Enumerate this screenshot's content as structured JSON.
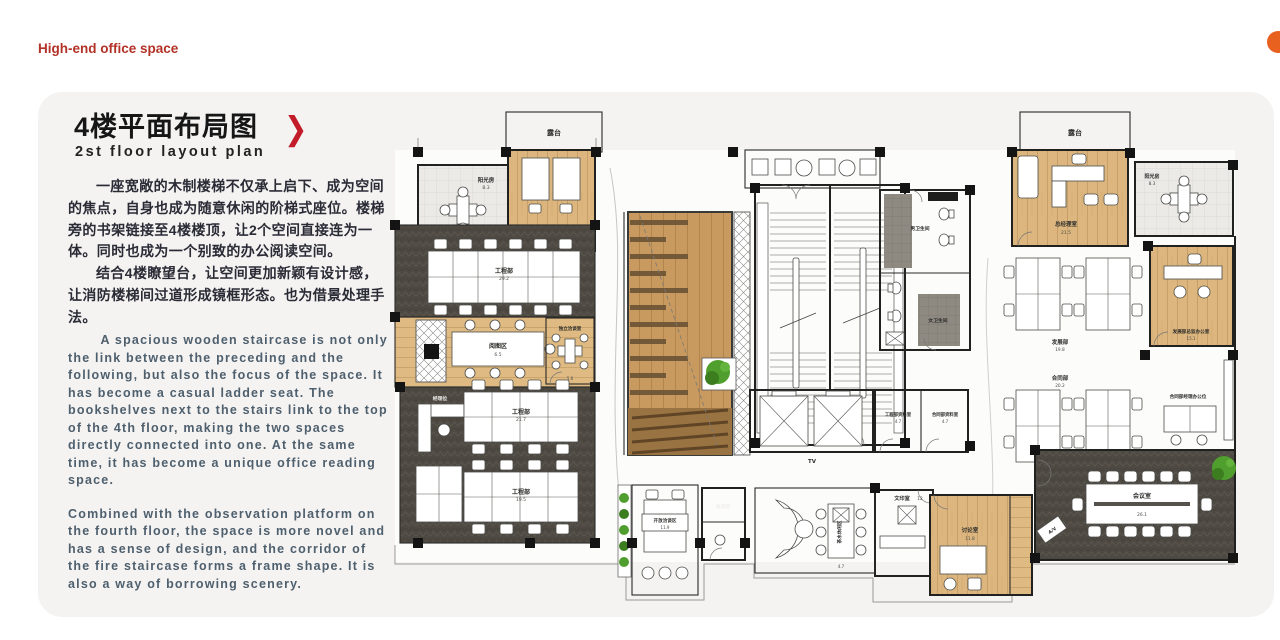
{
  "page": {
    "brand": "High-end office space"
  },
  "card": {
    "title": "4楼平面布局图",
    "subtitle": "2st floor layout plan",
    "arrow": "❯",
    "zh_paragraphs": [
      "一座宽敞的木制楼梯不仅承上启下、成为空间的焦点，自身也成为随意休闲的阶梯式座位。楼梯旁的书架链接至4楼楼顶，让2个空间直接连为一体。同时也成为一个别致的办公阅读空间。",
      "结合4楼瞭望台，让空间更加新颖有设计感，让消防楼梯间过道形成镜框形态。也为借景处理手法。"
    ],
    "en_paragraphs": [
      "A spacious wooden staircase is not only the link between the preceding and the following, but also the focus of the space. It has become a casual ladder seat. The bookshelves next to the stairs link to the top of the 4th floor, making the two spaces directly connected into one. At the same time, it has become a unique office reading space.",
      "Combined with the observation platform on the fourth floor, the space is more novel and has a sense of design, and the corridor of the fire staircase forms a frame shape. It is also a way of borrowing scenery."
    ]
  },
  "plan": {
    "labels": {
      "terrace_left": "露台",
      "terrace_right": "露台",
      "sunroom_left": "阳光房",
      "sunroom_right": "阳光房",
      "office_eng_director": "工程总监办公室",
      "eng_dept_1": "工程部",
      "eng_dept_2": "工程部",
      "eng_dept_3": "工程部",
      "manager_seat": "经理位",
      "reading_area": "阅图区",
      "indep_meeting": "独立洽谈室",
      "open_lounge": "开放洽谈区",
      "phone_room": "电话间",
      "tea_area": "茶水休闲区",
      "print_room": "文印室",
      "archive_eng": "工程部资料室",
      "archive_contract": "合同部资料室",
      "wc_men": "男卫生间",
      "wc_women": "女卫生间",
      "gm_office": "总经理室",
      "dev_dept": "发展部",
      "contract_dept": "合同部",
      "dev_director": "发展部总监办公室",
      "contract_mgr": "合同部经理办公位",
      "meeting_room": "会议室",
      "discussion_room": "讨论室",
      "tv": "TV",
      "av": "A/V"
    },
    "areas": {
      "sunroom_left": "8.3",
      "sunroom_right": "8.3",
      "office_eng_director": "26",
      "eng_dept_1": "29.2",
      "eng_dept_2": "21.7",
      "eng_dept_3": "19.5",
      "reading_area": "6.5",
      "indep_meeting": "5.6",
      "open_lounge": "11.9",
      "tea_area": "4.7",
      "print_room": "12",
      "archive_eng": "4.7",
      "archive_contract": "4.7",
      "gm_office": "21.5",
      "dev_dept": "19.8",
      "contract_dept": "20.2",
      "dev_director": "15.1",
      "meeting_room": "26.1",
      "discussion_room": "11.8"
    }
  },
  "colors": {
    "accent_red": "#c21b2a",
    "brand_red": "#b23227",
    "card_bg": "#f4f3f2",
    "carpet": "#4e4a43",
    "wood": "#dcb67e",
    "stair_wood": "#c89a5f",
    "plant_green": "#4f9e2e",
    "orange_dot": "#e8611f"
  }
}
